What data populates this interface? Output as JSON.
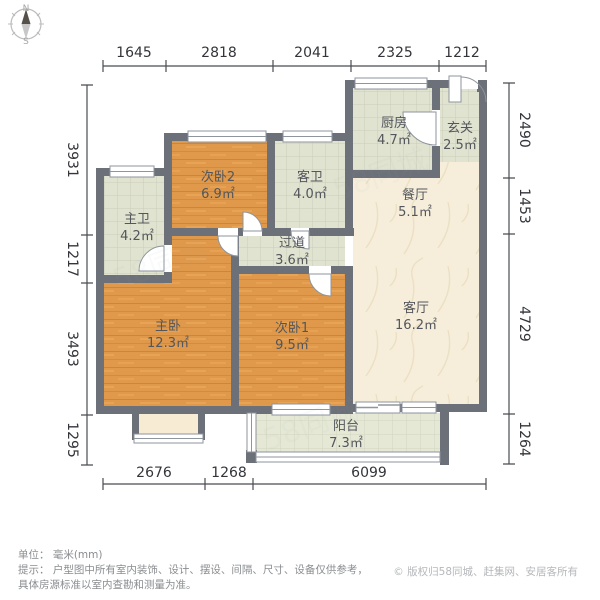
{
  "compass": {
    "north": "N",
    "south": "S"
  },
  "rooms": [
    {
      "id": "second-bedroom-2",
      "name": "次卧2",
      "area": "6.9㎡"
    },
    {
      "id": "guest-bathroom",
      "name": "客卫",
      "area": "4.0㎡"
    },
    {
      "id": "kitchen",
      "name": "厨房",
      "area": "4.7㎡"
    },
    {
      "id": "entryway",
      "name": "玄关",
      "area": "2.5㎡"
    },
    {
      "id": "dining-room",
      "name": "餐厅",
      "area": "5.1㎡"
    },
    {
      "id": "master-bathroom",
      "name": "主卫",
      "area": "4.2㎡"
    },
    {
      "id": "hallway",
      "name": "过道",
      "area": "3.6㎡"
    },
    {
      "id": "master-bedroom",
      "name": "主卧",
      "area": "12.3㎡"
    },
    {
      "id": "second-bedroom-1",
      "name": "次卧1",
      "area": "9.5㎡"
    },
    {
      "id": "living-room",
      "name": "客厅",
      "area": "16.2㎡"
    },
    {
      "id": "balcony",
      "name": "阳台",
      "area": "7.3㎡"
    }
  ],
  "dimensions": {
    "top": [
      "1645",
      "2818",
      "2041",
      "2325",
      "1212"
    ],
    "left": [
      "3931",
      "1217",
      "3493",
      "1295"
    ],
    "right": [
      "2490",
      "1453",
      "4729",
      "1264"
    ],
    "bottom": [
      "2676",
      "1268",
      "6099"
    ]
  },
  "footer": {
    "unit_line": "单位： 毫米(mm)",
    "tip_line1": "提示： 户型图中所有室内装饰、设计、摆设、间隔、尺寸、设备仅供参考，",
    "tip_line2": "具体房源标准以室内查勘和测量为准。",
    "copyright": "© 版权归58同城、赶集网、安居客所有"
  },
  "watermark": {
    "text": "58同城"
  },
  "colors": {
    "wall": "#6c7078",
    "wood_floor": "#e0994a",
    "tile_floor": "#e0e3cf",
    "marble_floor": "#f6eedb",
    "bay_window_fill": "#f7ecd3",
    "dim_text": "#33353a"
  }
}
